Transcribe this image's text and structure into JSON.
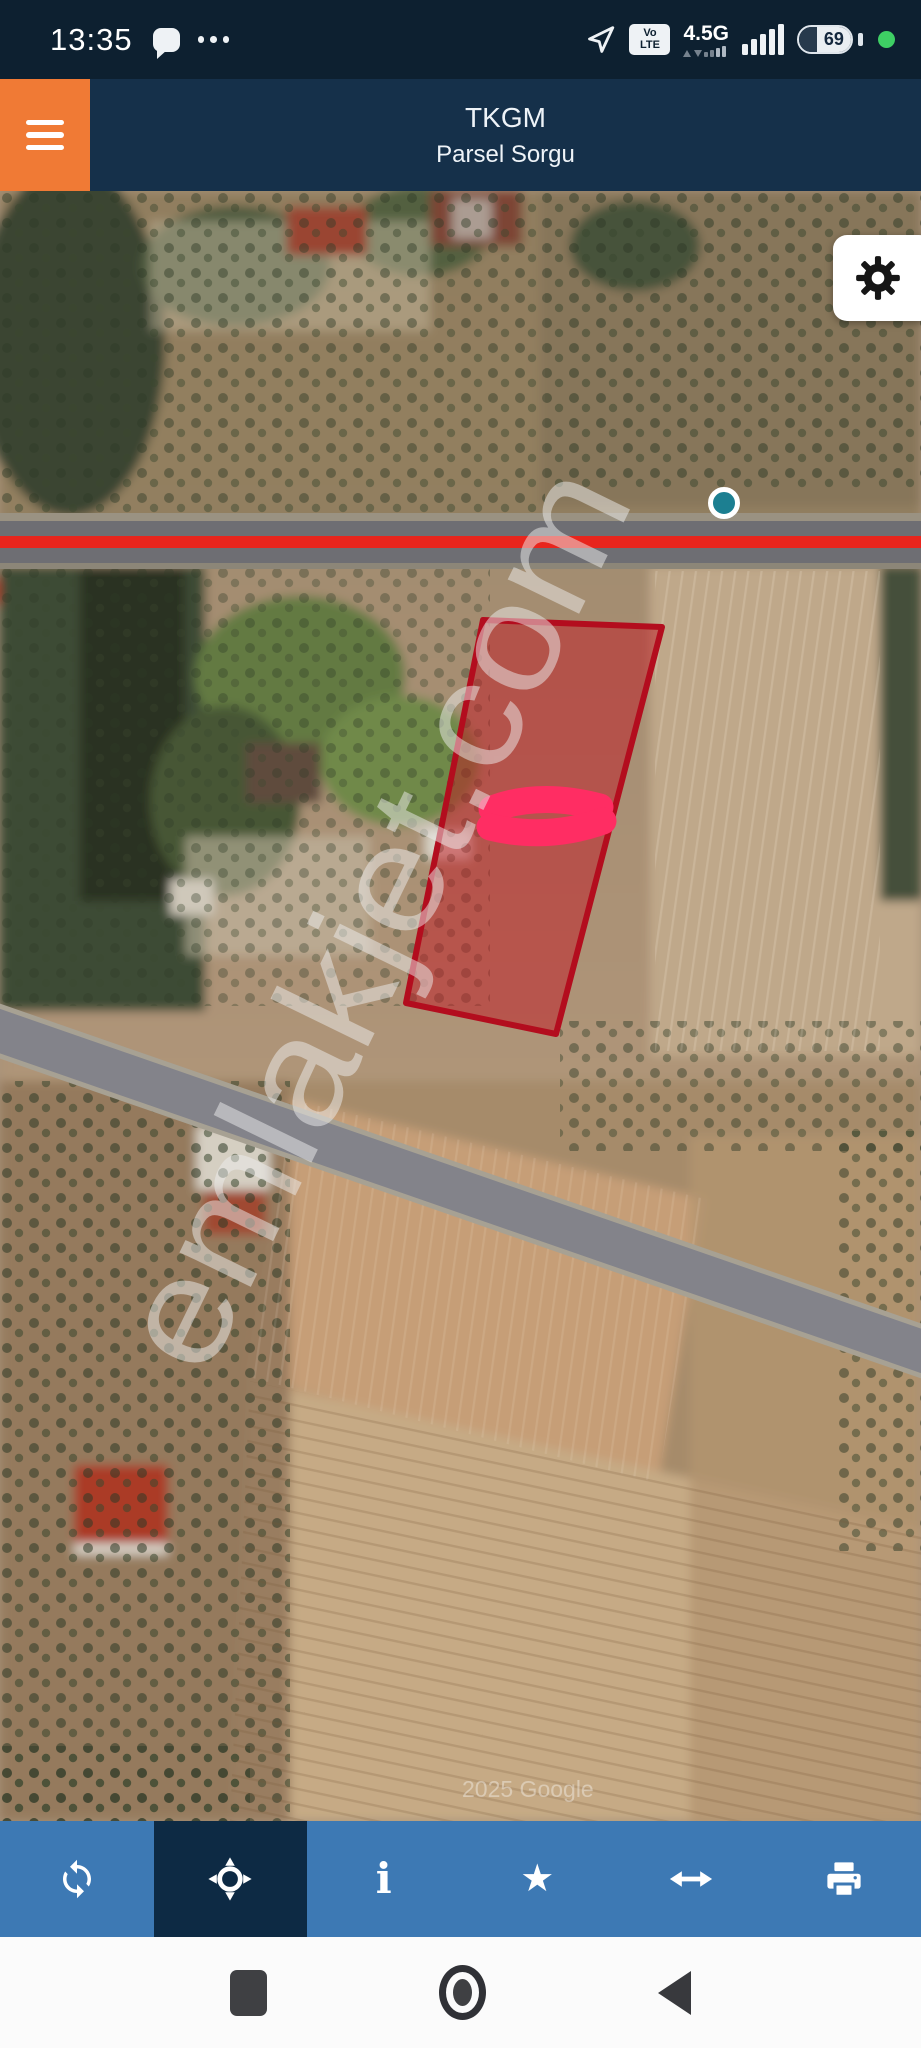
{
  "status_bar": {
    "time": "13:35",
    "volte_top": "Vo",
    "volte_bottom": "LTE",
    "network": "4.5G",
    "battery_percent": "69",
    "icons": [
      "message-bubble-icon",
      "more-dots-icon",
      "navigation-arrow-icon",
      "volte-badge",
      "signal-bars-icon",
      "battery-icon",
      "recording-dot"
    ]
  },
  "header": {
    "title": "TKGM",
    "subtitle": "Parsel Sorgu",
    "menu_icon": "hamburger"
  },
  "map": {
    "type": "satellite",
    "watermark": "emlakjet.com",
    "attribution": "2025 Google",
    "overlays": {
      "parcel_outline_color": "#b30d1e",
      "parcel_fill": "rgba(194,18,31,0.48)",
      "highlight_scribble_color": "#ff2d63",
      "road_highlight_color": "#e8251d",
      "marker_color": "#1c7f91"
    },
    "fab_icon": "gear"
  },
  "toolbar": {
    "active": "locate",
    "items": [
      {
        "icon": "refresh"
      },
      {
        "icon": "locate"
      },
      {
        "icon": "info",
        "glyph": "i"
      },
      {
        "icon": "star",
        "glyph": "★"
      },
      {
        "icon": "resize-horizontal"
      },
      {
        "icon": "print"
      }
    ]
  },
  "nav_bar": {
    "buttons": [
      "recents",
      "home",
      "back"
    ]
  },
  "colors": {
    "status_bar_bg": "#0d2030",
    "header_bg": "#15304a",
    "menu_orange": "#f07a35",
    "toolbar_bg": "#3d79b4",
    "toolbar_active_bg": "#0d2a44",
    "nav_bar_bg": "#fbfbfb"
  }
}
